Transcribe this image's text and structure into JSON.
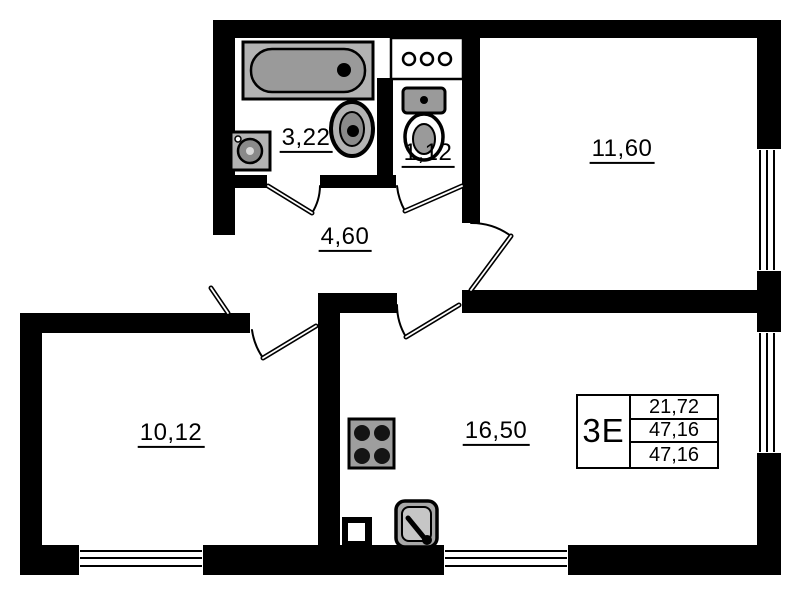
{
  "plan": {
    "rooms": [
      {
        "id": "bathroom",
        "area": "3,22"
      },
      {
        "id": "toilet",
        "area": "1,12"
      },
      {
        "id": "hallway",
        "area": "4,60"
      },
      {
        "id": "bedroom",
        "area": "11,60"
      },
      {
        "id": "room-second",
        "area": "10,12"
      },
      {
        "id": "kitchen-living",
        "area": "16,50"
      }
    ],
    "info_table": {
      "apartment_type": "3E",
      "rows": [
        "21,72",
        "47,16",
        "47,16"
      ]
    },
    "fixtures": [
      "bathtub",
      "washing-machine",
      "washbasin",
      "toilet-bowl",
      "vent-shaft",
      "stove",
      "kitchen-sink"
    ],
    "colors": {
      "walls": "#000000",
      "fixture_fill": "#a8a8a8",
      "background": "#ffffff"
    }
  }
}
